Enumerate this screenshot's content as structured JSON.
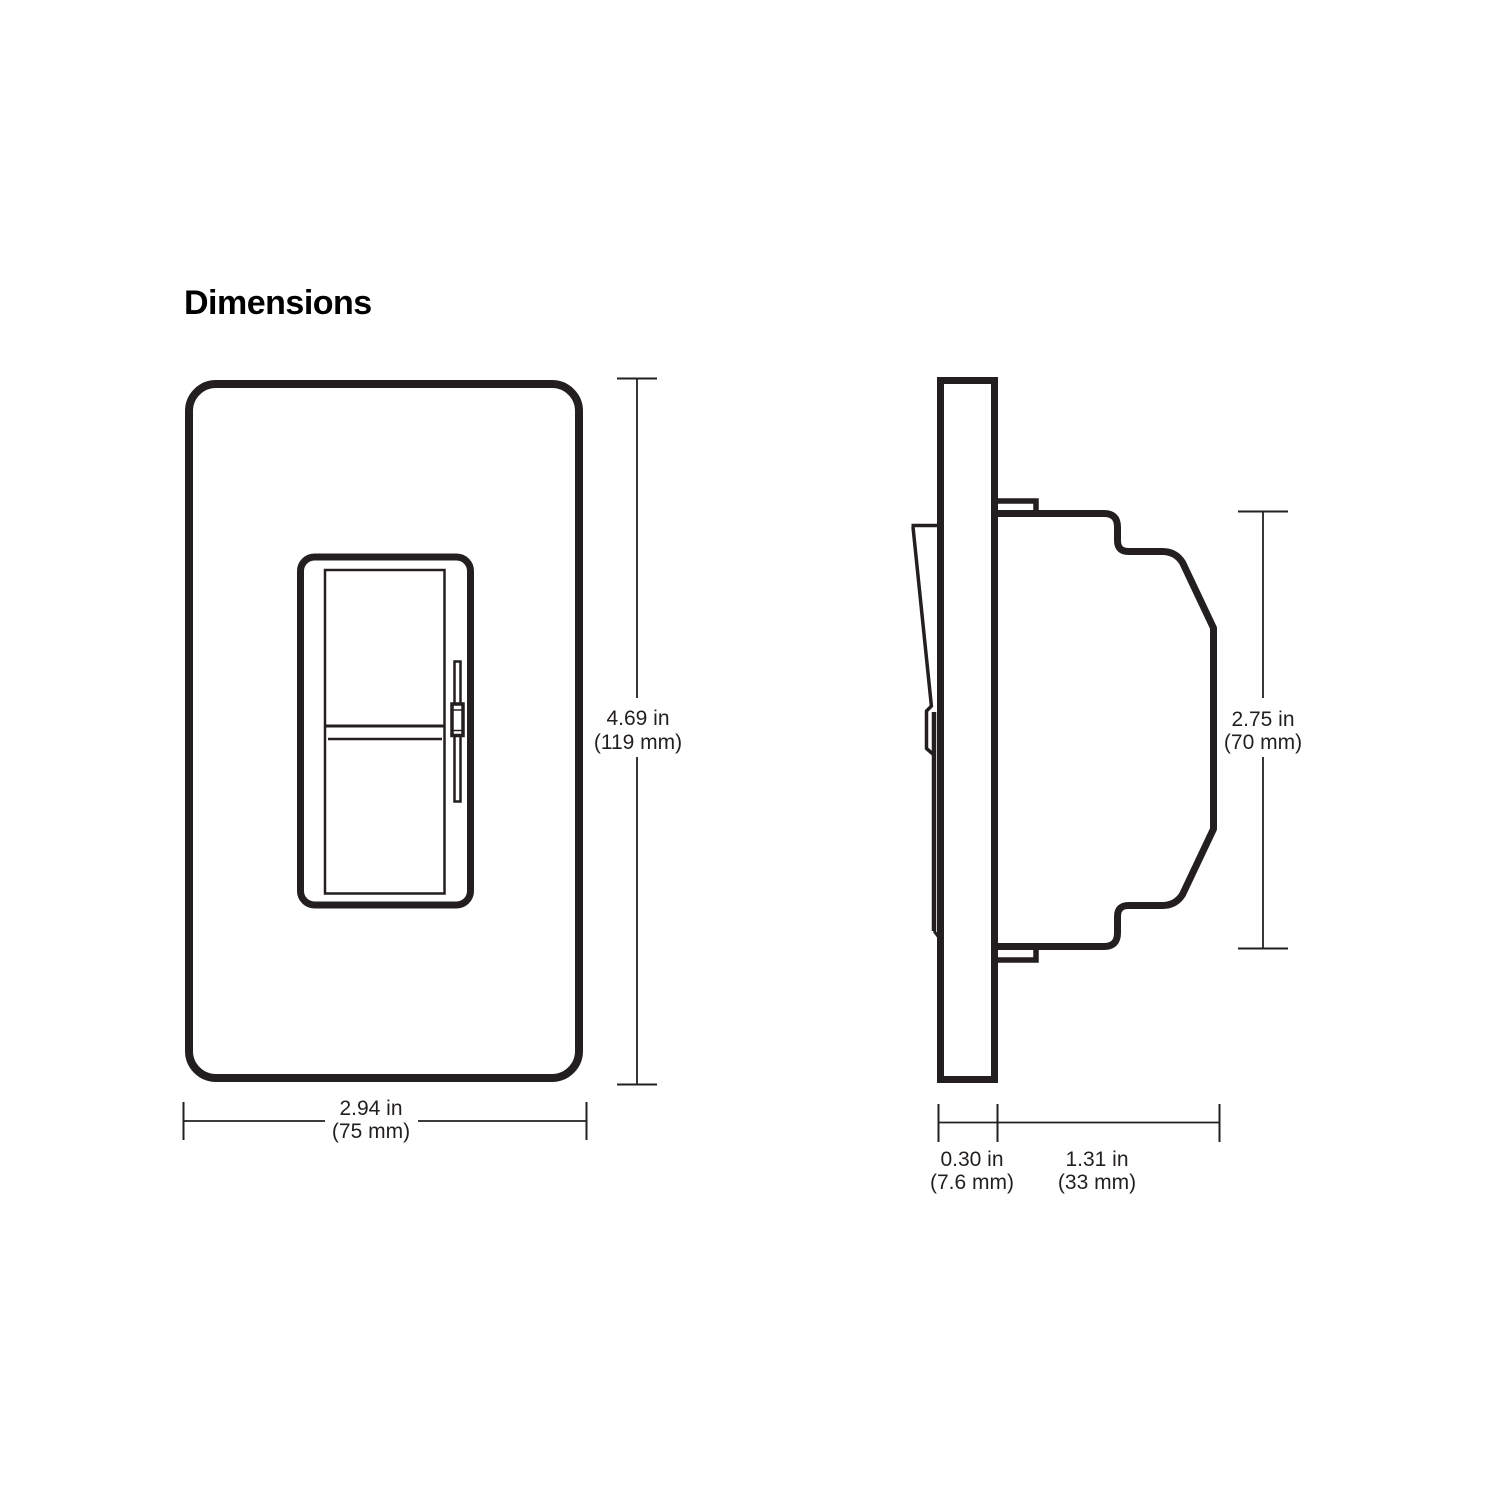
{
  "title": "Dimensions",
  "colors": {
    "ink": "#231f20",
    "background": "#ffffff"
  },
  "dimensions": {
    "front_height": {
      "inches": "4.69 in",
      "metric": "(119 mm)"
    },
    "front_width": {
      "inches": "2.94 in",
      "metric": "(75 mm)"
    },
    "side_height": {
      "inches": "2.75 in",
      "metric": "(70 mm)"
    },
    "wallplate_depth": {
      "inches": "0.30 in",
      "metric": "(7.6 mm)"
    },
    "body_depth": {
      "inches": "1.31 in",
      "metric": "(33 mm)"
    }
  }
}
